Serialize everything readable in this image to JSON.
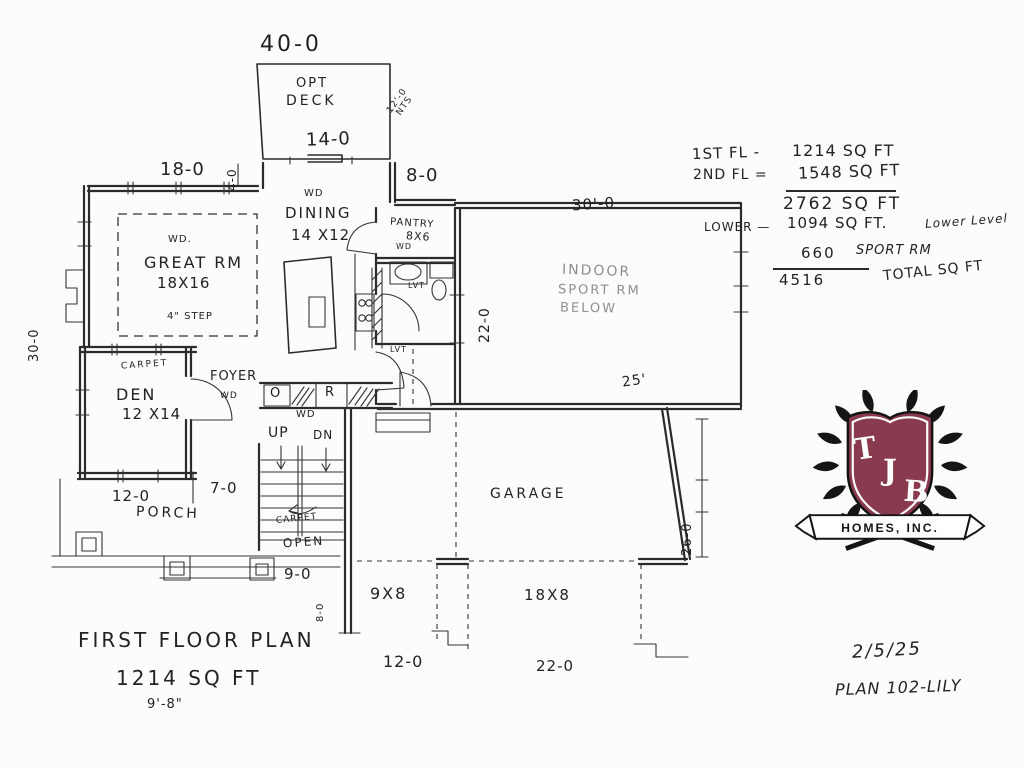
{
  "titleblock": {
    "title": "FIRST FLOOR PLAN",
    "sqft": "1214 SQ FT",
    "ceiling": "9'-8\"",
    "date": "2/5/25",
    "plan_no": "PLAN 102-LILY"
  },
  "areas": {
    "row1_label": "1ST FL -",
    "row1_value": "1214 SQ FT",
    "row2_label": "2ND FL =",
    "row2_value": "1548 SQ FT",
    "total_main": "2762 SQ FT",
    "row3_label": "LOWER —",
    "row3_value": "1094 SQ FT.",
    "row3_note": "Lower Level",
    "row4_value": "660",
    "row4_note": "SPORT RM",
    "grand_total": "4516",
    "grand_note": "TOTAL SQ FT"
  },
  "rooms": {
    "deck1": "OPT",
    "deck2": "DECK",
    "dining": "DINING",
    "dining_size": "14 X12",
    "pantry": "PANTRY",
    "pantry_size": "8X6",
    "great": "GREAT RM",
    "great_size": "18X16",
    "den": "DEN",
    "den_size": "12 X14",
    "foyer": "FOYER",
    "porch": "PORCH",
    "garage": "GARAGE",
    "sport1": "INDOOR",
    "sport2": "SPORT RM",
    "sport3": "BELOW"
  },
  "dims": {
    "w40": "40-0",
    "w14": "14-0",
    "nts1": "12'-0",
    "nts2": "NTS",
    "w18": "18-0",
    "h4": "4-0",
    "w8": "8-0",
    "w30t": "30'-0",
    "h30": "30-0",
    "h22": "22-0",
    "w25": "25'",
    "h26": "26-0",
    "w7": "7-0",
    "w12p": "12-0",
    "w9": "9-0",
    "h8": "8-0",
    "d9x8": "9X8",
    "d18x8": "18X8",
    "w12b": "12-0",
    "w22b": "22-0"
  },
  "notes": {
    "wd_dining": "WD",
    "wd_pantry": "WD",
    "wd_great": "WD.",
    "step": "4\" STEP",
    "carpet_den": "CARPET",
    "wd_foyer": "WD",
    "oven": "O",
    "fridge": "R",
    "wd_kitchen": "WD",
    "up": "UP",
    "dn": "DN",
    "carpet_stairs": "CARPET",
    "open": "OPEN",
    "lvt1": "LVT",
    "lvt2": "LVT"
  },
  "logo": {
    "letter_t": "T",
    "letter_j": "J",
    "letter_b": "B",
    "banner": "HOMES, INC.",
    "shield_color": "#8a3a4e"
  }
}
